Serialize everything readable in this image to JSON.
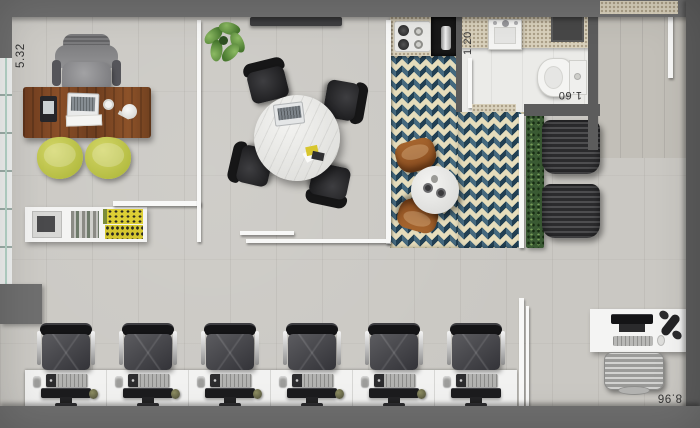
{
  "plan": {
    "type": "office-floor-plan",
    "view": "top-down"
  },
  "dimensions": {
    "left_depth": "5.32",
    "bathroom_width": "1.20",
    "bathroom_depth": "1.60",
    "bottom_width": "8.96"
  },
  "workstations": {
    "count": 6
  },
  "rooms": [
    {
      "name": "executive-office",
      "furniture": [
        "executive-chair",
        "wooden-desk",
        "laptop",
        "desk-phone",
        "papers",
        "mug",
        "desk-lamp",
        "guest-chair",
        "guest-chair",
        "credenza",
        "printer",
        "books",
        "yellow-magazines"
      ]
    },
    {
      "name": "meeting-room",
      "furniture": [
        "round-marble-table",
        "office-chair",
        "office-chair",
        "office-chair",
        "office-chair",
        "laptop",
        "media-console",
        "plant"
      ]
    },
    {
      "name": "pantry",
      "furniture": [
        "cooktop",
        "coffee-station",
        "round-marble-table",
        "wooden-stool",
        "wooden-stool",
        "patterned-tile-floor"
      ]
    },
    {
      "name": "bathroom",
      "furniture": [
        "counter",
        "sink",
        "toilet",
        "shelf"
      ]
    },
    {
      "name": "lounge",
      "furniture": [
        "ribbed-armchair",
        "ribbed-armchair",
        "hedge-planter"
      ]
    },
    {
      "name": "open-office",
      "furniture": [
        "workstation-desk-row",
        "task-chair",
        "monitor",
        "keyboard",
        "desk-phone",
        "accessory"
      ]
    },
    {
      "name": "reception",
      "furniture": [
        "desk",
        "monitor",
        "keyboard",
        "mouse",
        "phone-handset",
        "silver-chair"
      ]
    }
  ],
  "palette": {
    "outer_wall": "#6f6f6f",
    "floor": "#cac8c3",
    "tile_navy": "#2b4d63",
    "tile_cream": "#e6ddbc",
    "desk_wood": "#7c4526",
    "guest_chair_yellow": "#c0c64e",
    "hedge_green": "#3a5a33",
    "white_furniture": "#f4f4f3"
  }
}
